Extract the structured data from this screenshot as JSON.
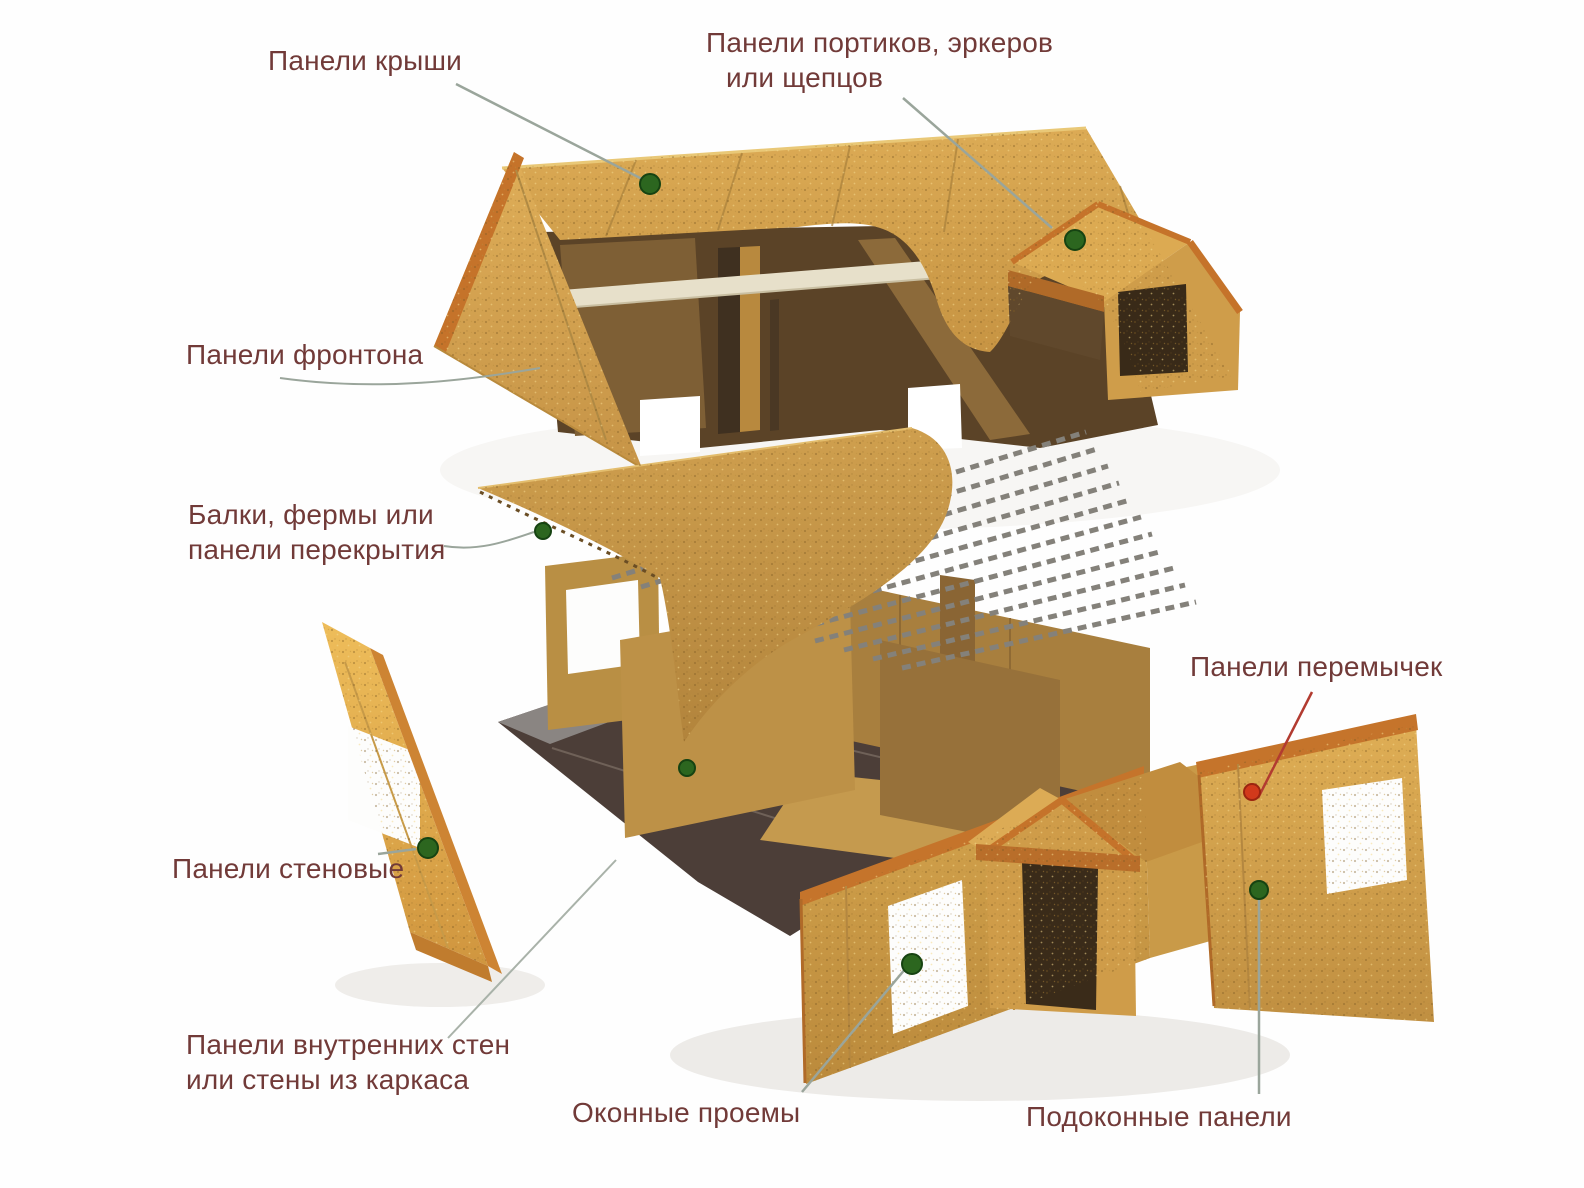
{
  "figure": {
    "description": "Exploded diagram of a SIP panel house",
    "labels": {
      "roof": {
        "text": "Панели крыши"
      },
      "portico": {
        "lines": [
          "Панели портиков, эркеров",
          "или щепцов"
        ]
      },
      "gable": {
        "text": "Панели фронтона"
      },
      "beams": {
        "lines": [
          "Балки, фермы или",
          "панели перекрытия"
        ]
      },
      "lintel": {
        "text": "Панели перемычек"
      },
      "wall": {
        "text": "Панели стеновые"
      },
      "interior": {
        "lines": [
          "Панели внутренних стен",
          "или стены из каркаса"
        ]
      },
      "window": {
        "text": "Оконные проемы"
      },
      "sill": {
        "text": "Подоконные панели"
      }
    },
    "colors": {
      "label_text": "#713a38",
      "marker_green": "#2c661f",
      "marker_red": "#d2391b",
      "leader_gray": "#9aa59b",
      "leader_red": "#b23b30",
      "osb_light": "#d8a64f",
      "osb_shadow": "#6b4e2a",
      "lumber_orange": "#c5732a",
      "floor_plate_dark": "#4c3e38",
      "ridge_beam_cream": "#e7e0ca"
    }
  }
}
